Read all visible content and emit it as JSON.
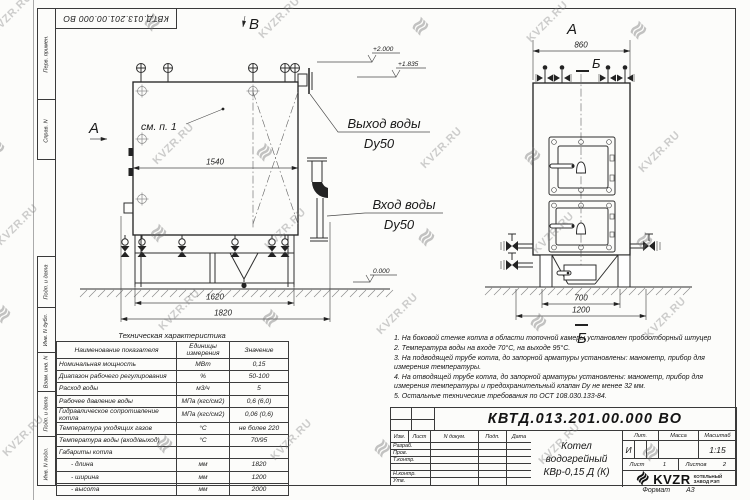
{
  "doc_code": "КВТД.013.201.00.000 ВО",
  "watermark": {
    "text": "KVZR.RU",
    "logo_glyph": "≋"
  },
  "frame": {
    "left_labels": [
      "Перв. примен.",
      "Справ. N",
      "Подп. и дата",
      "Инв. N дубл.",
      "Взам. инв. N",
      "Подп. и дата",
      "Инв. N подл."
    ],
    "format_label": "Формат",
    "format_value": "А3"
  },
  "views": {
    "front": {
      "top_label": "В",
      "view_label": "А",
      "see_ref": "см. п. 1",
      "dim_inner": "1540",
      "dim_frame": "1620",
      "dim_overall": "1820",
      "level_top": "+2.000",
      "level_mid": "+1.835",
      "level_zero": "0.000",
      "outlet_line1": "Выход воды",
      "outlet_line2": "Dy50",
      "inlet_line1": "Вход воды",
      "inlet_line2": "Dy50"
    },
    "side": {
      "view_label": "А",
      "section_top": "Б",
      "section_bottom": "Б",
      "dim_width": "860",
      "dim_inner": "700",
      "dim_overall": "1200"
    }
  },
  "spec": {
    "title": "Техническая характеристика",
    "headers": [
      "Наименование показателя",
      "Единицы измерения",
      "Значение"
    ],
    "rows": [
      [
        "Номинальная мощность",
        "МВт",
        "0,15"
      ],
      [
        "Диапазон рабочего регулирования",
        "%",
        "50-100"
      ],
      [
        "Расход воды",
        "м3/ч",
        "5"
      ],
      [
        "Рабочее давление воды",
        "МПа (кгс/см2)",
        "0,6 (6,0)"
      ],
      [
        "Гидравлическое сопротивление котла",
        "МПа (кгс/см2)",
        "0,06 (0,6)"
      ],
      [
        "Температура уходящих газов",
        "°С",
        "не более 220"
      ],
      [
        "Температура воды (вход/выход)",
        "°С",
        "70/95"
      ],
      [
        "Габариты котла",
        "",
        ""
      ],
      [
        "- длина",
        "мм",
        "1820"
      ],
      [
        "- ширина",
        "мм",
        "1200"
      ],
      [
        "- высота",
        "мм",
        "2000"
      ]
    ]
  },
  "notes": [
    "1. На боковой стенке котла в области топочной камеры установлен пробоотборный штуцер",
    "2. Температура воды на входе 70°С, на выходе 95°С.",
    "3. На подводящей трубе котла, до запорной арматуры установлены: манометр, прибор для измерения температуры.",
    "4. На отводящей трубе котла, до запорной арматуры установлены: манометр, прибор для измерения температуры и предохранительный клапан Dy не менее 32 мм.",
    "5. Остальные технические требования по ОСТ 108.030.133-84."
  ],
  "title_block": {
    "code": "КВТД.013.201.00.000 ВО",
    "name_line1": "Котел водогрейный",
    "name_line2": "КВр-0,15 Д (К)",
    "col_headers": [
      "Изм.",
      "Лист",
      "N докум.",
      "Подп.",
      "Дата"
    ],
    "row_labels": [
      "Разраб.",
      "Пров.",
      "Т.контр.",
      "",
      "Н.контр.",
      "Утв."
    ],
    "lit_header": "Лит.",
    "mass_header": "Масса",
    "scale_header": "Масштаб",
    "lit_value": "И",
    "scale_value": "1:15",
    "sheet_label": "Лист",
    "sheet_value": "1",
    "sheets_label": "Листов",
    "sheets_value": "2",
    "logo_text": "KVZR",
    "logo_sub1": "КОТЕЛЬНЫЙ",
    "logo_sub2": "ЗАВОД РЭП"
  }
}
